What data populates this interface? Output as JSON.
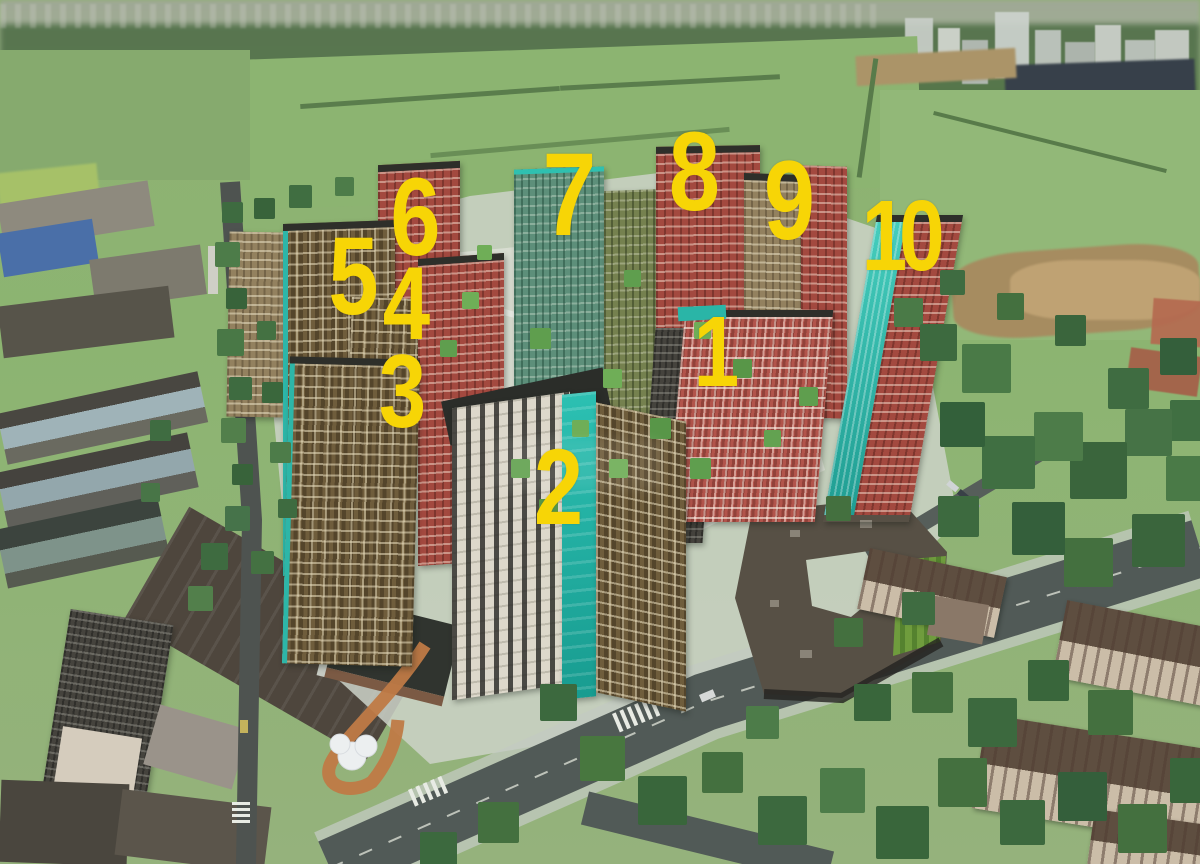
{
  "markers": [
    {
      "id": "building-1",
      "label": "1"
    },
    {
      "id": "building-2",
      "label": "2"
    },
    {
      "id": "building-3",
      "label": "3"
    },
    {
      "id": "building-4",
      "label": "4"
    },
    {
      "id": "building-5",
      "label": "5"
    },
    {
      "id": "building-6",
      "label": "6"
    },
    {
      "id": "building-7",
      "label": "7"
    },
    {
      "id": "building-8",
      "label": "8"
    },
    {
      "id": "building-9",
      "label": "9"
    },
    {
      "id": "building-10",
      "label": "10"
    }
  ],
  "palette": {
    "marker_yellow": "#f7d506",
    "teal_accent": "#27b4a6",
    "red_facade": "#a3493f",
    "brown_facade": "#6f5d3c",
    "grass_green": "#8cb471",
    "asphalt_gray": "#515a57",
    "roof_dark": "#2b2d29"
  }
}
